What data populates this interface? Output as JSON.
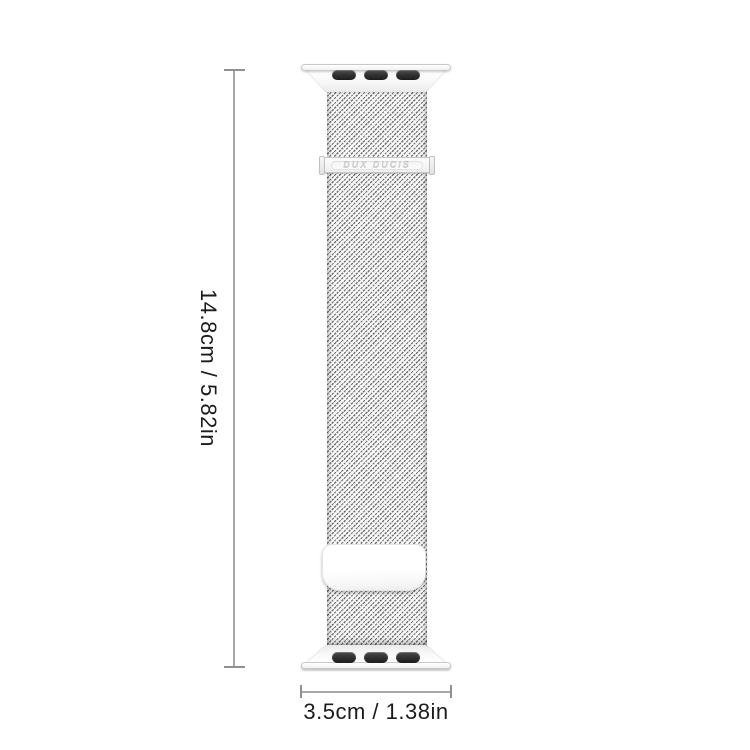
{
  "canvas": {
    "width": 750,
    "height": 750,
    "background": "#ffffff"
  },
  "product": {
    "type": "milanese-loop-watch-band",
    "finish": "silver",
    "brand_label": "DUX DUCIS",
    "colors": {
      "hardware_fill": "#fafafa",
      "hardware_edge": "#c9c9c9",
      "mesh_dark": "#6e6e6e",
      "mesh_light": "#ffffff",
      "lug_slot": "#1c1c1c"
    }
  },
  "annotations": {
    "height_label": "14.8cm / 5.82in",
    "width_label": "3.5cm / 1.38in",
    "line_color": "#a6a6a6",
    "text_color": "#1b1b1b"
  }
}
